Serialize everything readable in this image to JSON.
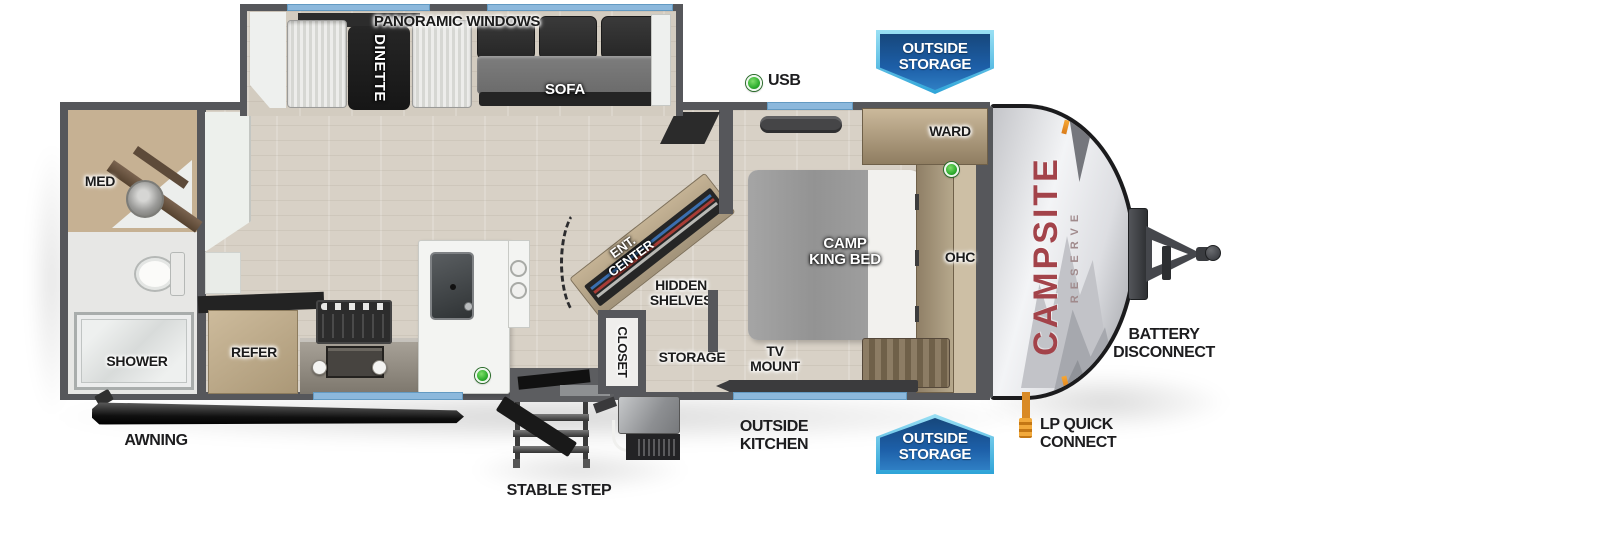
{
  "floorplan": {
    "slideout": {
      "panoramic_windows": "PANORAMIC WINDOWS",
      "dinette": "DINETTE",
      "sofa": "SOFA"
    },
    "bathroom": {
      "med": "MED",
      "shower": "SHOWER"
    },
    "kitchen": {
      "refer": "REFER"
    },
    "living": {
      "ent_center": "ENT.\nCENTER",
      "hidden_shelves": "HIDDEN\nSHELVES",
      "closet": "CLOSET",
      "storage": "STORAGE"
    },
    "bedroom": {
      "bed": "CAMP\nKING BED",
      "ward": "WARD",
      "ohc": "OHC",
      "tv_mount": "TV\nMOUNT"
    },
    "brand": {
      "primary": "CAMPSITE",
      "secondary": "RESERVE"
    }
  },
  "callouts": {
    "usb": "USB",
    "outside_storage_top": "OUTSIDE\nSTORAGE",
    "outside_storage_bottom": "OUTSIDE\nSTORAGE",
    "outside_kitchen": "OUTSIDE\nKITCHEN",
    "battery_disconnect": "BATTERY\nDISCONNECT",
    "lp_quick_connect": "LP QUICK\nCONNECT",
    "stable_step": "STABLE STEP",
    "awning": "AWNING"
  },
  "colors": {
    "wall": "#56575b",
    "floor_wood": "#d8d1c6",
    "window_blue": "#8cb8dc",
    "badge_blue": "#1d5fa8",
    "badge_border": "#5ec1e6",
    "usb_marker_green": "#3cb53c",
    "brand_red": "#a3434a",
    "clearance_light_orange": "#f0962e"
  }
}
